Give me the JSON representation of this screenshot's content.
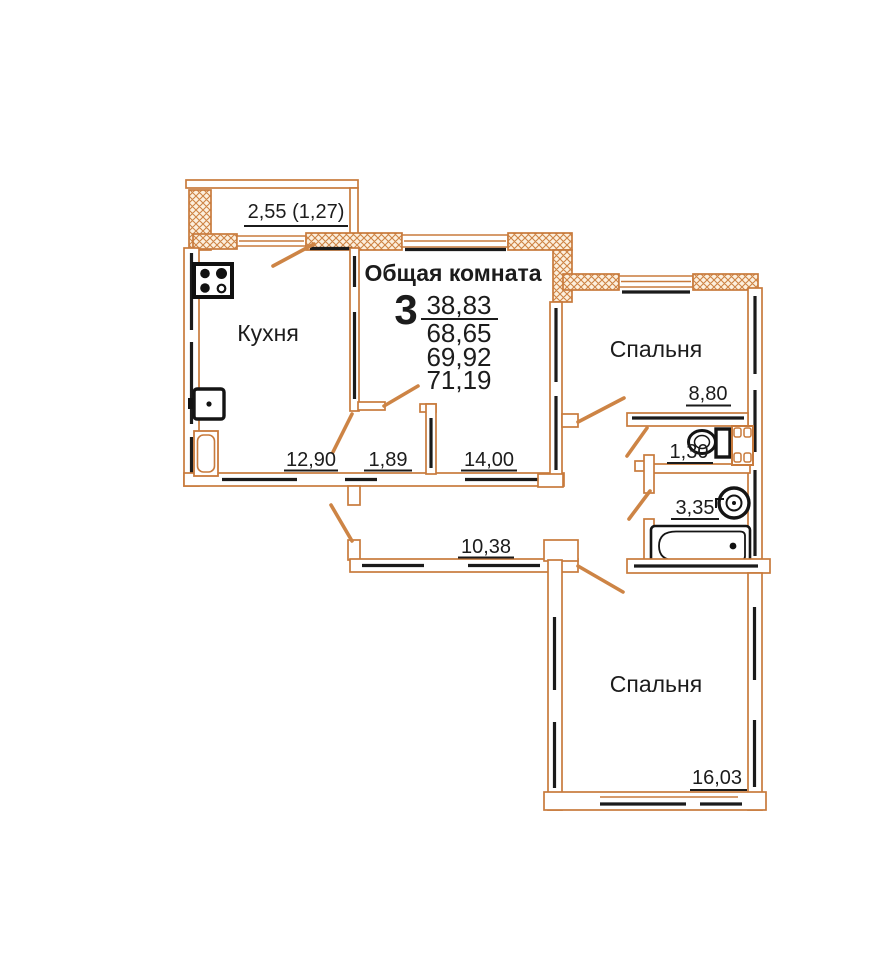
{
  "colors": {
    "wall_orange": "#c87a3c",
    "line_black": "#1b1b1b"
  },
  "balcony": {
    "dimension": "2,55 (1,27)"
  },
  "kitchen": {
    "label": "Кухня",
    "dimension": "12,90"
  },
  "closet": {
    "dimension": "1,89"
  },
  "common_room": {
    "label": "Общая комната",
    "room_count": "3",
    "living_area": "38,83",
    "total_area": "68,65",
    "total_area_with_coeff": "69,92",
    "total_area_with_balcony": "71,19",
    "dimension": "14,00"
  },
  "bedroom_top": {
    "label": "Спальня",
    "dimension": "8,80"
  },
  "wc": {
    "dimension": "1,30"
  },
  "bathroom": {
    "dimension": "3,35"
  },
  "corridor": {
    "dimension": "10,38"
  },
  "bedroom_bottom": {
    "label": "Спальня",
    "dimension": "16,03"
  }
}
